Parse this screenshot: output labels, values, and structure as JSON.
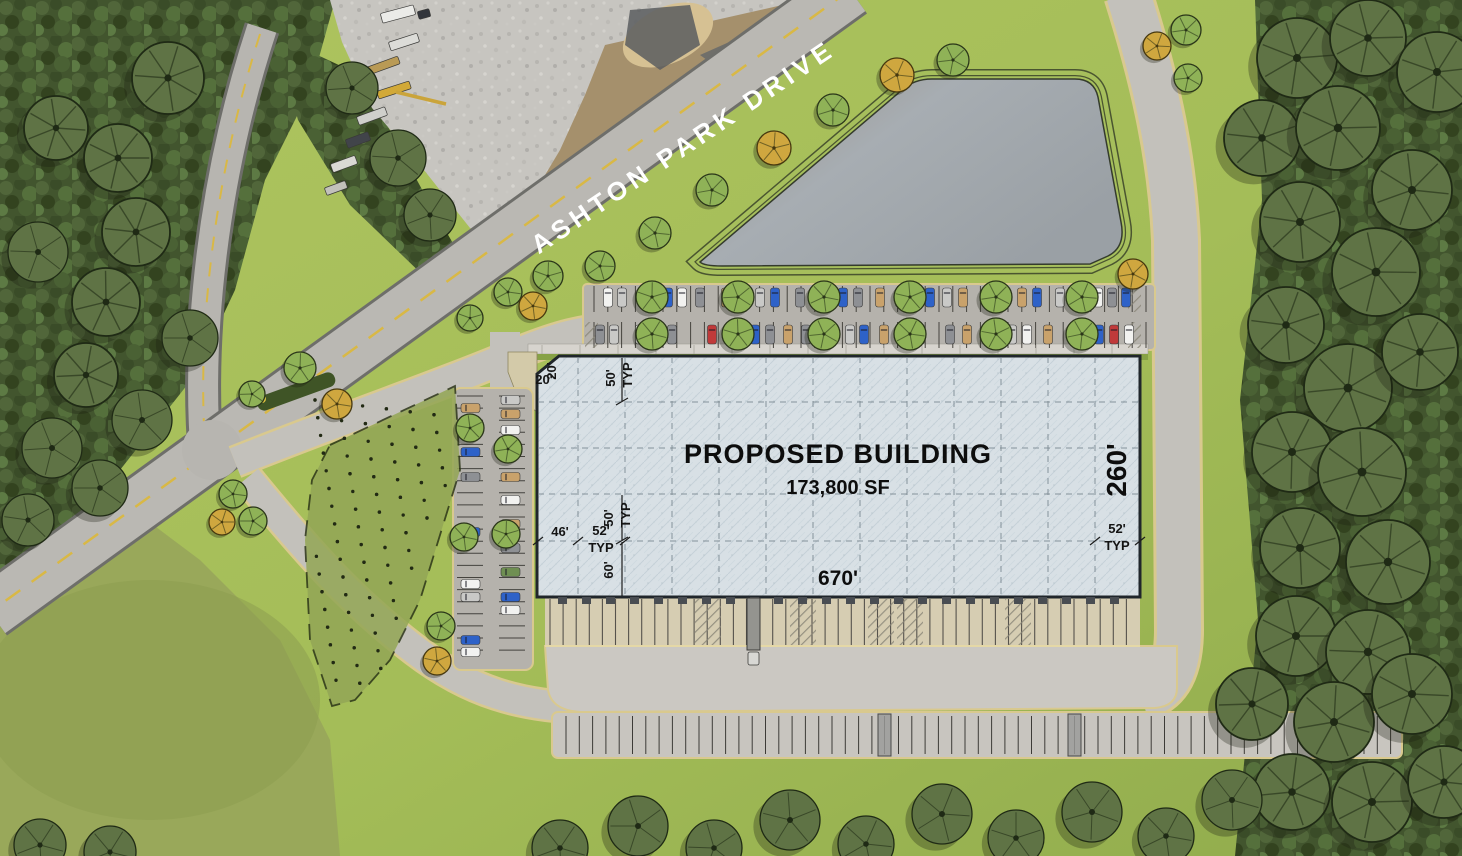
{
  "labels": {
    "road_name": "ASHTON PARK DRIVE",
    "building_title": "PROPOSED BUILDING",
    "building_area": "173,800 SF",
    "dim_length": "670'",
    "dim_depth": "260'",
    "dim_setback_top": "20'",
    "dim_setback_side": "20'",
    "dim_bay_top": "50'",
    "dim_bay_mid": "50'",
    "dim_bay_bottom": "60'",
    "dim_bay_width": "52'",
    "dim_bay_width_right": "52'",
    "dim_end_bay": "46'",
    "typ_top": "TYP",
    "typ_mid": "TYP",
    "typ_left": "TYP",
    "typ_right": "TYP"
  },
  "colors": {
    "grass": "#a4bd58",
    "forest": "#42552e",
    "road": "#bab8b3",
    "road_edge": "#6e6e6a",
    "drive": "#c3c1bb",
    "curb": "#d9c98e",
    "asphalt": "#b5b2ac",
    "concrete": "#cbc8c2",
    "dock_apron": "#d6cdb2",
    "building_fill": "#d8e0e5",
    "building_border": "#20262b",
    "pond": "#a7adb2",
    "gravel": "#c7c5c0",
    "dirt": "#a5906c",
    "centerline_yellow": "#d9b845",
    "label_dark": "#0d0d0d",
    "label_white": "#ffffff"
  },
  "scene": {
    "tree_colors": {
      "g": [
        "#8fb257",
        "#2a3519"
      ],
      "o": [
        "#cfa73f",
        "#46380f"
      ],
      "d": [
        "#5f7345",
        "#1f2a15"
      ]
    },
    "trees": [
      [
        897,
        75,
        17,
        "o"
      ],
      [
        953,
        60,
        16,
        "g"
      ],
      [
        833,
        110,
        16,
        "g"
      ],
      [
        774,
        148,
        17,
        "o"
      ],
      [
        712,
        190,
        16,
        "g"
      ],
      [
        655,
        233,
        16,
        "g"
      ],
      [
        600,
        266,
        15,
        "g"
      ],
      [
        548,
        276,
        15,
        "g"
      ],
      [
        508,
        292,
        14,
        "g"
      ],
      [
        533,
        306,
        14,
        "o"
      ],
      [
        470,
        318,
        13,
        "g"
      ],
      [
        300,
        368,
        16,
        "g"
      ],
      [
        337,
        404,
        15,
        "o"
      ],
      [
        252,
        394,
        13,
        "g"
      ],
      [
        233,
        494,
        14,
        "g"
      ],
      [
        222,
        522,
        13,
        "o"
      ],
      [
        253,
        521,
        14,
        "g"
      ],
      [
        470,
        428,
        14,
        "g"
      ],
      [
        508,
        449,
        14,
        "g"
      ],
      [
        464,
        537,
        14,
        "g"
      ],
      [
        506,
        534,
        14,
        "g"
      ],
      [
        441,
        626,
        14,
        "g"
      ],
      [
        437,
        661,
        14,
        "o"
      ],
      [
        652,
        297,
        16,
        "g"
      ],
      [
        738,
        297,
        16,
        "g"
      ],
      [
        824,
        297,
        16,
        "g"
      ],
      [
        910,
        297,
        16,
        "g"
      ],
      [
        996,
        297,
        16,
        "g"
      ],
      [
        1082,
        297,
        16,
        "g"
      ],
      [
        652,
        334,
        16,
        "g"
      ],
      [
        738,
        334,
        16,
        "g"
      ],
      [
        824,
        334,
        16,
        "g"
      ],
      [
        910,
        334,
        16,
        "g"
      ],
      [
        996,
        334,
        16,
        "g"
      ],
      [
        1082,
        334,
        16,
        "g"
      ],
      [
        1133,
        274,
        15,
        "o"
      ],
      [
        1186,
        30,
        15,
        "g"
      ],
      [
        1157,
        46,
        14,
        "o"
      ],
      [
        1188,
        78,
        14,
        "g"
      ],
      [
        1297,
        58,
        40,
        "d"
      ],
      [
        1368,
        38,
        38,
        "d"
      ],
      [
        1437,
        72,
        40,
        "d"
      ],
      [
        1262,
        138,
        38,
        "d"
      ],
      [
        1338,
        128,
        42,
        "d"
      ],
      [
        1412,
        190,
        40,
        "d"
      ],
      [
        1300,
        222,
        40,
        "d"
      ],
      [
        1376,
        272,
        44,
        "d"
      ],
      [
        1286,
        325,
        38,
        "d"
      ],
      [
        1348,
        388,
        44,
        "d"
      ],
      [
        1420,
        352,
        38,
        "d"
      ],
      [
        1292,
        452,
        40,
        "d"
      ],
      [
        1362,
        472,
        44,
        "d"
      ],
      [
        1300,
        548,
        40,
        "d"
      ],
      [
        1388,
        562,
        42,
        "d"
      ],
      [
        1296,
        636,
        40,
        "d"
      ],
      [
        1368,
        652,
        42,
        "d"
      ],
      [
        1252,
        704,
        36,
        "d"
      ],
      [
        1334,
        722,
        40,
        "d"
      ],
      [
        1412,
        694,
        40,
        "d"
      ],
      [
        1292,
        792,
        38,
        "d"
      ],
      [
        1372,
        802,
        40,
        "d"
      ],
      [
        1444,
        782,
        36,
        "d"
      ],
      [
        560,
        848,
        28,
        "d"
      ],
      [
        638,
        826,
        30,
        "d"
      ],
      [
        714,
        848,
        28,
        "d"
      ],
      [
        790,
        820,
        30,
        "d"
      ],
      [
        866,
        844,
        28,
        "d"
      ],
      [
        942,
        814,
        30,
        "d"
      ],
      [
        1016,
        838,
        28,
        "d"
      ],
      [
        1092,
        812,
        30,
        "d"
      ],
      [
        1166,
        836,
        28,
        "d"
      ],
      [
        1232,
        800,
        30,
        "d"
      ],
      [
        40,
        845,
        26,
        "d"
      ],
      [
        110,
        852,
        26,
        "d"
      ],
      [
        168,
        78,
        36,
        "d"
      ],
      [
        118,
        158,
        34,
        "d"
      ],
      [
        136,
        232,
        34,
        "d"
      ],
      [
        106,
        302,
        34,
        "d"
      ],
      [
        86,
        375,
        32,
        "d"
      ],
      [
        142,
        420,
        30,
        "d"
      ],
      [
        52,
        448,
        30,
        "d"
      ],
      [
        38,
        252,
        30,
        "d"
      ],
      [
        56,
        128,
        32,
        "d"
      ],
      [
        190,
        338,
        28,
        "d"
      ],
      [
        28,
        520,
        26,
        "d"
      ],
      [
        100,
        488,
        28,
        "d"
      ],
      [
        352,
        88,
        26,
        "d"
      ],
      [
        398,
        158,
        28,
        "d"
      ],
      [
        430,
        215,
        26,
        "d"
      ]
    ],
    "vehicles": {
      "car_colors": {
        "w": "#f2f2f0",
        "s": "#c9c9c7",
        "g": "#8e9094",
        "b": "#2e62c8",
        "r": "#c03a3a",
        "t": "#c9a26b",
        "v": "#6f8f52"
      },
      "row_top": {
        "y": 288,
        "cars": [
          [
            608,
            "w"
          ],
          [
            622,
            "s"
          ],
          [
            668,
            "b"
          ],
          [
            682,
            "w"
          ],
          [
            700,
            "g"
          ],
          [
            726,
            "t"
          ],
          [
            760,
            "s"
          ],
          [
            775,
            "b"
          ],
          [
            800,
            "g"
          ],
          [
            843,
            "b"
          ],
          [
            858,
            "g"
          ],
          [
            880,
            "t"
          ],
          [
            900,
            "w"
          ],
          [
            930,
            "b"
          ],
          [
            947,
            "s"
          ],
          [
            963,
            "t"
          ],
          [
            1022,
            "t"
          ],
          [
            1037,
            "b"
          ],
          [
            1060,
            "s"
          ],
          [
            1098,
            "w"
          ],
          [
            1112,
            "g"
          ],
          [
            1126,
            "b"
          ]
        ]
      },
      "row_mid": {
        "y": 325,
        "cars": [
          [
            600,
            "g"
          ],
          [
            614,
            "s"
          ],
          [
            640,
            "w"
          ],
          [
            654,
            "b"
          ],
          [
            672,
            "g"
          ],
          [
            712,
            "r"
          ],
          [
            755,
            "b"
          ],
          [
            770,
            "g"
          ],
          [
            788,
            "t"
          ],
          [
            806,
            "g"
          ],
          [
            850,
            "s"
          ],
          [
            864,
            "b"
          ],
          [
            884,
            "t"
          ],
          [
            902,
            "w"
          ],
          [
            920,
            "s"
          ],
          [
            950,
            "g"
          ],
          [
            967,
            "t"
          ],
          [
            1012,
            "s"
          ],
          [
            1027,
            "w"
          ],
          [
            1048,
            "t"
          ],
          [
            1084,
            "s"
          ],
          [
            1099,
            "b"
          ],
          [
            1114,
            "r"
          ],
          [
            1129,
            "w"
          ]
        ]
      },
      "col_left_outer": {
        "x": 461,
        "cars": [
          [
            408,
            "t"
          ],
          [
            452,
            "b"
          ],
          [
            477,
            "g"
          ],
          [
            532,
            "b"
          ],
          [
            584,
            "w"
          ],
          [
            597,
            "s"
          ],
          [
            640,
            "b"
          ],
          [
            652,
            "w"
          ]
        ]
      },
      "col_left_inner": {
        "x": 501,
        "cars": [
          [
            400,
            "s"
          ],
          [
            414,
            "t"
          ],
          [
            430,
            "w"
          ],
          [
            452,
            "s"
          ],
          [
            477,
            "t"
          ],
          [
            500,
            "w"
          ],
          [
            524,
            "t"
          ],
          [
            548,
            "g"
          ],
          [
            572,
            "v"
          ],
          [
            597,
            "b"
          ],
          [
            610,
            "w"
          ]
        ]
      },
      "trailers": [
        878,
        1068
      ],
      "dock_truck_x": 747,
      "construction": [
        [
          398,
          14,
          34,
          10,
          "#ebebe8",
          -15
        ],
        [
          424,
          14,
          12,
          8,
          "#33363c",
          -15
        ],
        [
          404,
          42,
          30,
          9,
          "#dcdcd8",
          -18
        ],
        [
          382,
          66,
          36,
          8,
          "#b99a55",
          -20
        ],
        [
          394,
          90,
          34,
          8,
          "#d2a937",
          -18
        ],
        [
          372,
          116,
          30,
          9,
          "#cfcfcb",
          -20
        ],
        [
          358,
          140,
          24,
          9,
          "#41444a",
          -20
        ],
        [
          344,
          164,
          26,
          9,
          "#dad9d4",
          -20
        ],
        [
          336,
          188,
          22,
          8,
          "#c2c1bb",
          -20
        ]
      ]
    }
  }
}
